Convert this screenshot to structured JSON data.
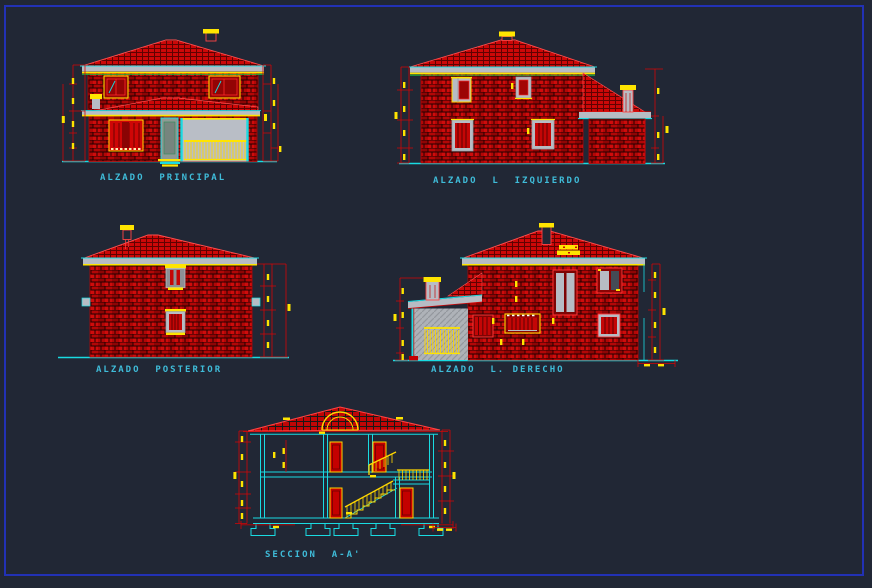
{
  "sheet": {
    "type_label": "architectural elevations and section CAD sheet",
    "background_color": "#212735",
    "frame_color": "#2231b5"
  },
  "palette": {
    "brick_red": "#b30707",
    "bright_red": "#d40606",
    "dark_red": "#7e0303",
    "yellow": "#ffe400",
    "cyan": "#19dbe2",
    "grey": "#b7bcc4",
    "green": "#17c44a",
    "label_text": "#3fbcd9"
  },
  "drawings": [
    {
      "id": "alzado-principal",
      "label": "ALZADO  PRINCIPAL"
    },
    {
      "id": "alzado-izquierdo",
      "label": "ALZADO  L  IZQUIERDO"
    },
    {
      "id": "alzado-posterior",
      "label": "ALZADO  POSTERIOR"
    },
    {
      "id": "alzado-derecho",
      "label": "ALZADO  L. DERECHO"
    },
    {
      "id": "seccion-aa",
      "label": "SECCION  A-A'"
    }
  ]
}
